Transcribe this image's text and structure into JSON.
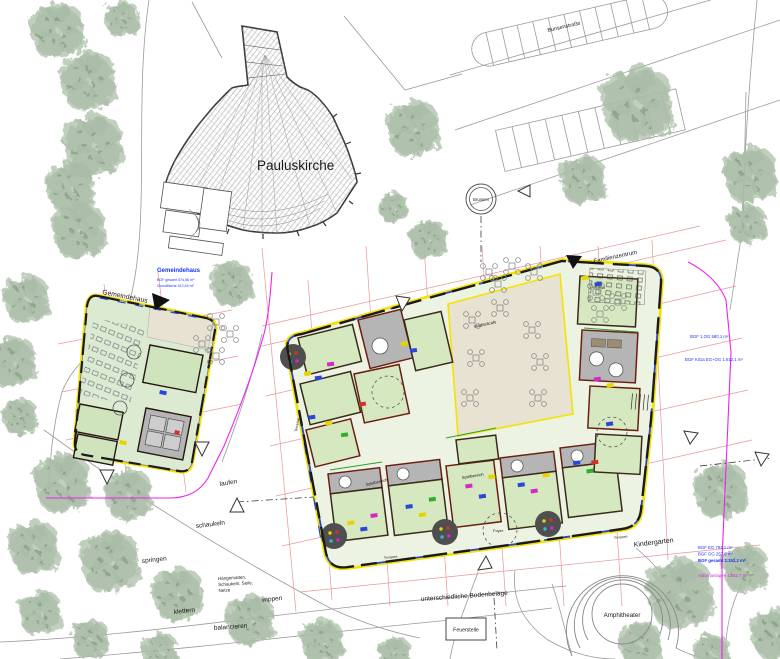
{
  "plan": {
    "buildings": {
      "pauluskirche": "Pauluskirche",
      "gemeindehaus": "Gemeindehaus",
      "familienzentrum": "Familienzentrum",
      "kindergarten": "Kindergarten"
    },
    "places": {
      "stadtteilcafe": "Stadtteilcafe",
      "cafeteria": "Cafeteria",
      "brunnen": "Brunnen",
      "amphitheater": "Amphitheater",
      "feuerstelle": "Feuerstelle",
      "bodenbelaege": "unterschiedliche Bodenbeläge",
      "strasse": "Bunsenstraße",
      "terrasse": "Terrasse",
      "foyer": "Foyer",
      "spielbereich": "Spielbereich"
    },
    "playground": {
      "laufen": "laufen",
      "schaukeln": "schaukeln",
      "springen": "springen",
      "wippen": "wippen",
      "klettern": "klettern",
      "balancieren": "balancieren",
      "haengematten_l1": "Hängematten,",
      "haengematten_l2": "Schaukeln, Seile,",
      "haengematten_l3": "Netze"
    },
    "annotations": {
      "gemeindehaus_title": "Gemeindehaus",
      "gemeindehaus_l1": "BGF gesamt  574,56 m²",
      "gemeindehaus_l2": "Grundfläche  412,04 m²",
      "kiga_right_l1": "BGF 1.OG  580,1 m²",
      "kiga_right_l2": "BGF KiGa EG+OG  1.612,1 m²",
      "kiga_bottom_l1": "BGF EG  794,1 m²",
      "kiga_bottom_l2": "BGF OG  257,8 m²",
      "kiga_bottom_l3": "BGF gesamt  2.152,2 m²",
      "kiga_bottom_l4": "Außenanlagen  4.052,7 m²"
    },
    "colors": {
      "outline_yellow": "#f4e300",
      "boundary_magenta": "#ee22ee",
      "dimension_red": "#e58585",
      "room_green": "#d6e8c0",
      "courtyard_beige": "#e7e2d1",
      "tree_green": "#a3b8a0",
      "window_blue": "#2744d0",
      "annotation_blue": "#1a35ff",
      "sanitary_gray": "#b5b5b5"
    }
  }
}
